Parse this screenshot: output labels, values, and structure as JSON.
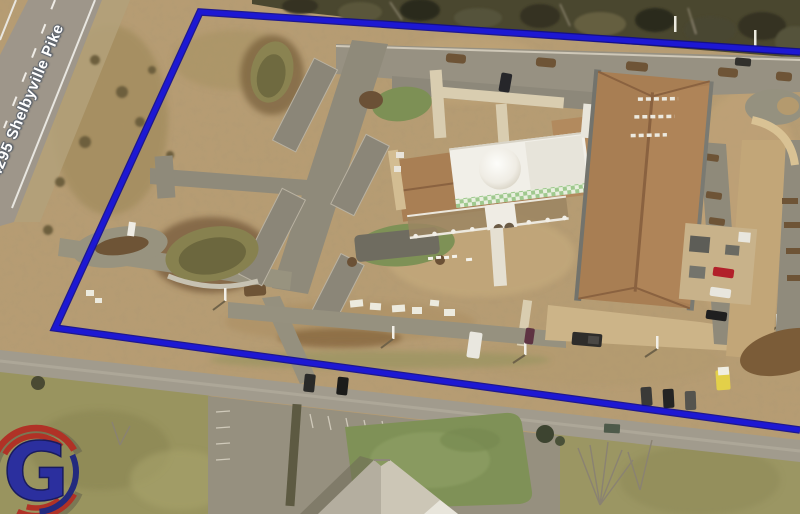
{
  "map": {
    "road_label": "4295 Shelbyville Pike",
    "logo": {
      "letter": "G",
      "letter_color": "#2b2f9e",
      "arc_red": "#b03226",
      "arc_navy": "#232a7e"
    },
    "parcel": {
      "points": "800,52 200,12 55,328 800,430",
      "outline_color": "#1d18d3",
      "outline_casing": "#0e0a90"
    },
    "palette": {
      "dirt": "#b89d73",
      "trees": "#4a472f",
      "asphalt": "#9e968a",
      "parking": "#8f8a7a",
      "roof_brown": "#a87e53",
      "roof_white": "#f1efe8",
      "lawn": "#7d9055",
      "field_grass": "#99945f",
      "pond": "#87814f",
      "concrete_apron": "#c9b084",
      "grass_patch": "#7f9157"
    },
    "features": [
      "shelbyville-pike-road",
      "tree-line",
      "north-parking",
      "entrance-loop",
      "retention-pond-north",
      "retention-pond-south",
      "main-building",
      "white-dome-roof",
      "colonnade",
      "frontage-road",
      "bottom-parking-lot",
      "south-building",
      "parcel-boundary"
    ]
  }
}
